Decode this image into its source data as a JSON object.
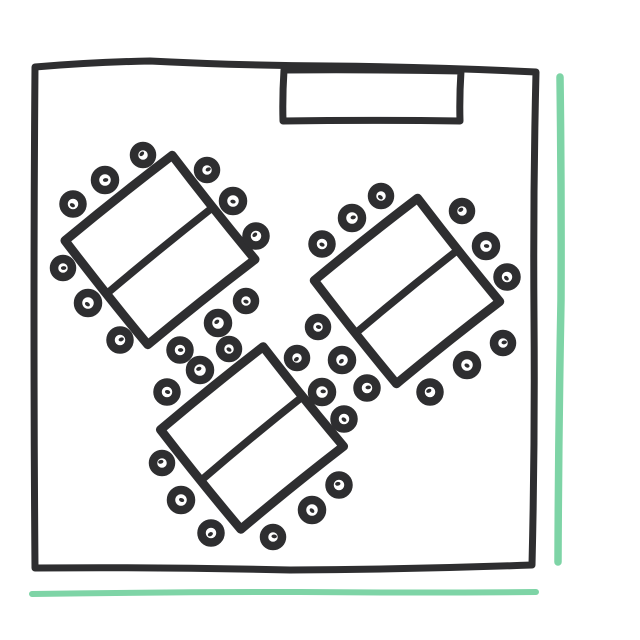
{
  "scene": {
    "kind": "hand-drawn-floor-plan",
    "canvas": {
      "width": 640,
      "height": 640
    }
  },
  "colors": {
    "ink": "#2e2e30",
    "accent_teal": "#7ed4a6",
    "background": "#ffffff"
  },
  "room": {
    "outline_points": [
      [
        35,
        67
      ],
      [
        150,
        61
      ],
      [
        330,
        66
      ],
      [
        536,
        72
      ],
      [
        534,
        318
      ],
      [
        532,
        565
      ],
      [
        290,
        570
      ],
      [
        35,
        568
      ]
    ],
    "stage_rect_points": [
      [
        284,
        70
      ],
      [
        461,
        71
      ],
      [
        460,
        121
      ],
      [
        283,
        121
      ]
    ]
  },
  "tables": [
    {
      "id": "table-1",
      "cx": 160,
      "cy": 250,
      "width": 137,
      "height": 133,
      "angle": -38.5,
      "chairs": [
        [
          143,
          155
        ],
        [
          105,
          180
        ],
        [
          73,
          204
        ],
        [
          207,
          170
        ],
        [
          233,
          201
        ],
        [
          256,
          236
        ],
        [
          63,
          268
        ],
        [
          88,
          303
        ],
        [
          120,
          340
        ],
        [
          246,
          301
        ],
        [
          218,
          323
        ],
        [
          180,
          350
        ]
      ]
    },
    {
      "id": "table-2",
      "cx": 407,
      "cy": 291,
      "width": 132,
      "height": 132,
      "angle": -38.5,
      "chairs": [
        [
          381,
          196
        ],
        [
          352,
          218
        ],
        [
          322,
          244
        ],
        [
          462,
          211
        ],
        [
          486,
          246
        ],
        [
          507,
          277
        ],
        [
          503,
          343
        ],
        [
          467,
          365
        ],
        [
          430,
          392
        ],
        [
          318,
          327
        ],
        [
          342,
          360
        ],
        [
          367,
          388
        ]
      ]
    },
    {
      "id": "table-3",
      "cx": 252,
      "cy": 438,
      "width": 132,
      "height": 128,
      "angle": -38.9,
      "chairs": [
        [
          229,
          349
        ],
        [
          200,
          370
        ],
        [
          167,
          392
        ],
        [
          297,
          358
        ],
        [
          322,
          392
        ],
        [
          344,
          419
        ],
        [
          162,
          463
        ],
        [
          181,
          500
        ],
        [
          211,
          533
        ],
        [
          273,
          537
        ],
        [
          312,
          510
        ],
        [
          339,
          485
        ]
      ]
    }
  ],
  "accent_lines": [
    {
      "id": "right-accent-line",
      "points": [
        [
          560,
          77
        ],
        [
          561,
          300
        ],
        [
          558,
          562
        ]
      ],
      "width": 7.5
    },
    {
      "id": "bottom-accent-line",
      "points": [
        [
          32,
          594
        ],
        [
          300,
          592
        ],
        [
          536,
          592
        ]
      ],
      "width": 6
    }
  ]
}
